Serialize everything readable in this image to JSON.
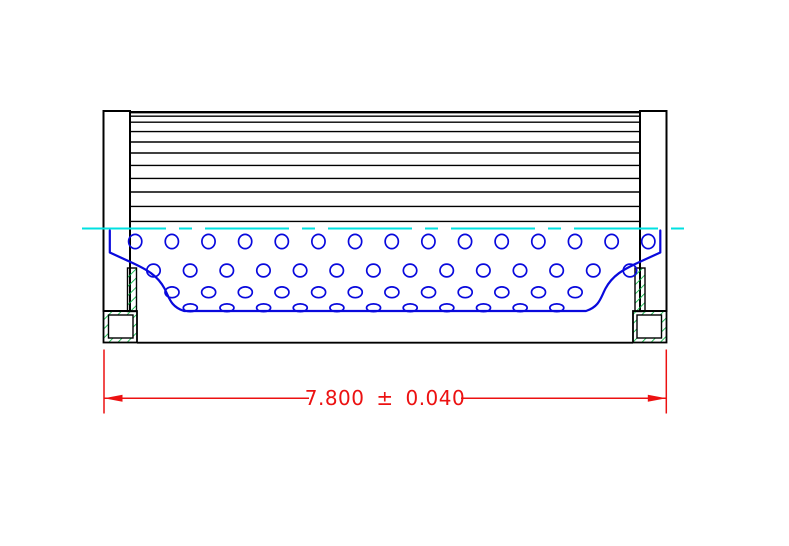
{
  "colors": {
    "background": "#ffffff",
    "outline": "#000000",
    "core": "#0909dd",
    "centerline": "#00e1e1",
    "gasket_hatch": "#00b43c",
    "dimension": "#ec1111"
  },
  "dimension": {
    "label": "7.800 ± 0.040",
    "nominal": "7.800",
    "tolerance": "±0.040"
  },
  "drawing": {
    "pleat_lines_y": [
      116.2,
      122.2,
      131.6,
      142,
      153,
      165.4,
      178.4,
      192,
      206.4,
      221.4
    ],
    "pleat_x1": 130,
    "pleat_x2": 641.5,
    "hole_rows": [
      {
        "cy": 241.5,
        "rx": 6.6,
        "ry": 7.1,
        "x0": 135.2,
        "step": 36.65,
        "count": 15
      },
      {
        "cy": 270.5,
        "rx": 6.7,
        "ry": 6.4,
        "x0": 153.5,
        "step": 36.65,
        "count": 14
      },
      {
        "cy": 292.3,
        "rx": 7.0,
        "ry": 5.4,
        "x0": 172.0,
        "step": 36.65,
        "count": 12
      },
      {
        "cy": 307.8,
        "rx": 7.0,
        "ry": 3.9,
        "x0": 190.3,
        "step": 36.65,
        "count": 11
      }
    ]
  }
}
